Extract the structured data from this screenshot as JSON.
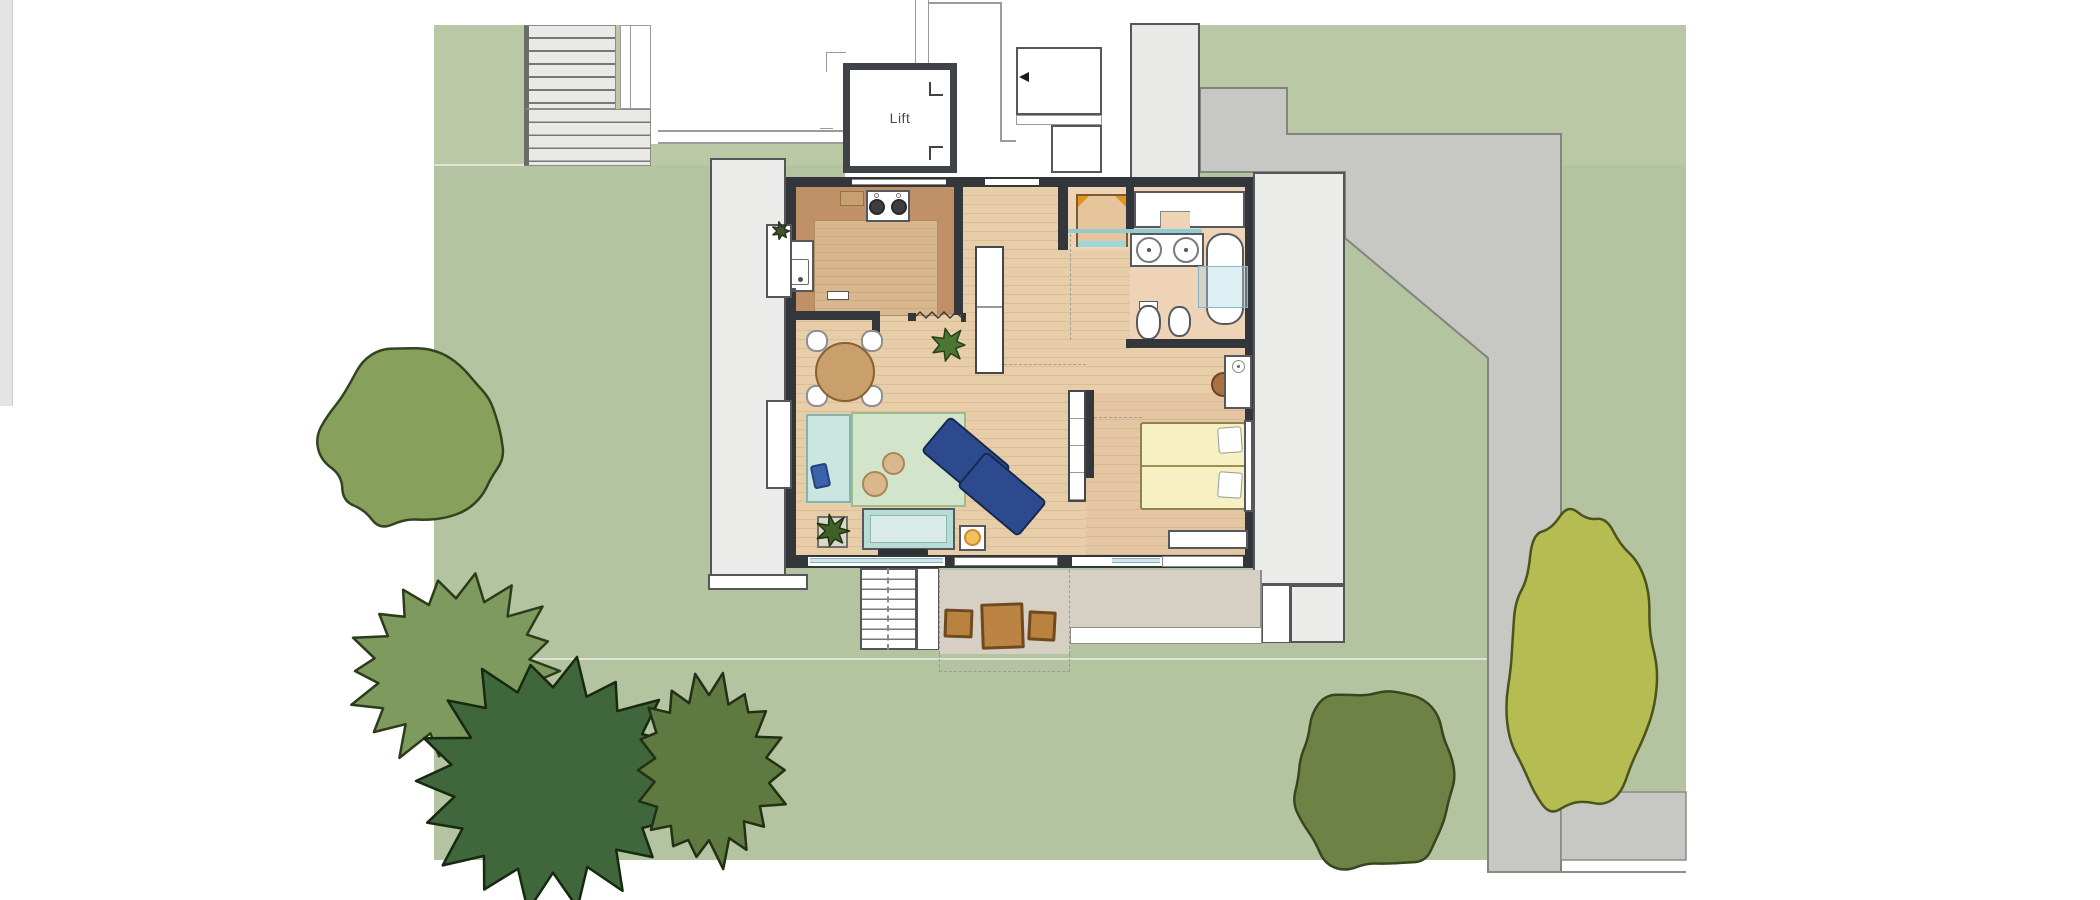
{
  "plan": {
    "lift_label": "Lift"
  },
  "colors": {
    "lawn": "#b4c4a0",
    "lawn_upper": "#bac8a6",
    "lawn_line": "rgba(255,255,255,0.55)",
    "driveway": "#c7c8c3",
    "driveway_edge": "#83847f",
    "stair_fill": "#e9e9e7",
    "tread": "#787873",
    "structure_edge": "#55565a",
    "deck": "#ebecea",
    "wall": "#33363b",
    "wall_light": "#9b9b97",
    "floor_wood": "#e8cda9",
    "kitchen_counter": "#c09166",
    "kitchen_floor": "#d9b78e",
    "room_warm": "#eed3b6",
    "bedroom_floor": "#e4c6a3",
    "rug": "#d2e5ca",
    "mat": "#cbe5e0",
    "tv_board": "#b7dbd5",
    "sofa": "#2c4a8d",
    "sofa_edge": "#16294e",
    "bed": "#f6f0c3",
    "terrace": "#d6cfc4",
    "stool": "#b9833f",
    "stool_edge": "#6f4a1e",
    "glass": "#cfe7ec",
    "glass_line": "#8fcdd3",
    "table_wood": "#c99f6b",
    "accent_orange": "#d2882f"
  },
  "garden": {
    "trees": [
      {
        "name": "tree-round-upper-left",
        "style": "lumpy",
        "cx": 415,
        "cy": 437,
        "rx": 93,
        "ry": 93,
        "fill": "#87a05b",
        "stroke": "#33431f",
        "seed": 7
      },
      {
        "name": "tree-spiky-left",
        "style": "spiky",
        "cx": 456,
        "cy": 671,
        "rx": 97,
        "ry": 86,
        "fill": "#7e9a5f",
        "stroke": "#2c3c1b",
        "seed": 3
      },
      {
        "name": "tree-dark-large",
        "style": "spiky",
        "cx": 553,
        "cy": 781,
        "rx": 124,
        "ry": 113,
        "fill": "#40663c",
        "stroke": "#152a10",
        "seed": 11
      },
      {
        "name": "tree-spiky-small",
        "style": "spiky",
        "cx": 709,
        "cy": 770,
        "rx": 70,
        "ry": 86,
        "fill": "#5e7a41",
        "stroke": "#243016",
        "seed": 5
      },
      {
        "name": "tree-round-bottom",
        "style": "lumpy",
        "cx": 1376,
        "cy": 779,
        "rx": 84,
        "ry": 96,
        "fill": "#6f8245",
        "stroke": "#39451f",
        "seed": 9
      },
      {
        "name": "tree-olive-tall",
        "style": "lumpy",
        "cx": 1578,
        "cy": 668,
        "rx": 76,
        "ry": 153,
        "fill": "#b5bc52",
        "stroke": "#4c531b",
        "seed": 13
      }
    ],
    "plants": [
      {
        "name": "plant-dining",
        "style": "burst",
        "cx": 949,
        "cy": 345,
        "rx": 16,
        "ry": 16,
        "fill": "#4c7433",
        "stroke": "#27421a",
        "seed": 21
      },
      {
        "name": "plant-living",
        "style": "burst",
        "cx": 833,
        "cy": 531,
        "rx": 15,
        "ry": 15,
        "fill": "#3f6029",
        "stroke": "#1e330f",
        "seed": 22
      },
      {
        "name": "plant-kitchen-star",
        "style": "burst",
        "cx": 781,
        "cy": 231,
        "rx": 8,
        "ry": 8,
        "fill": "#44522e",
        "stroke": "#2a3519",
        "seed": 23
      }
    ]
  }
}
